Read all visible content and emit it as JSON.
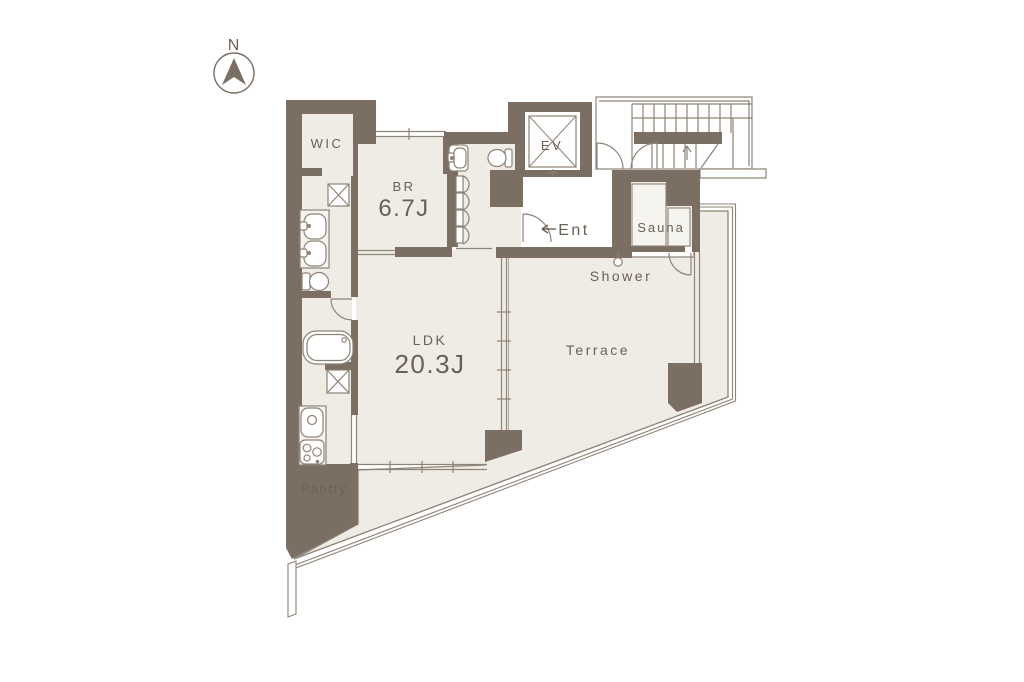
{
  "title": "apartment-floor-plan",
  "palette": {
    "wall": "#7b6e62",
    "floor": "#efece5",
    "line": "#8d8376",
    "text": "#6b6054",
    "white": "#ffffff",
    "bench": "#f6f4ee"
  },
  "compass": {
    "label": "N"
  },
  "rooms": {
    "wic": {
      "label": "WIC"
    },
    "br": {
      "label": "BR",
      "size": "6.7J"
    },
    "ev": {
      "label": "EV"
    },
    "ent": {
      "label": "Ent"
    },
    "sauna": {
      "label": "Sauna"
    },
    "shower": {
      "label": "Shower"
    },
    "ldk": {
      "label": "LDK",
      "size": "20.3J"
    },
    "terrace": {
      "label": "Terrace"
    },
    "pantry": {
      "label": "Pantry"
    }
  },
  "fixtures": [
    "compass-north-icon",
    "washing-machine-pan-icon",
    "double-vanity-icon",
    "toilet-icon",
    "bathtub-icon",
    "kitchen-sink-icon",
    "stove-icon",
    "shower-head-icon",
    "elevator-icon",
    "staircase-icon",
    "door-swing-icon",
    "sauna-bench-icon"
  ]
}
